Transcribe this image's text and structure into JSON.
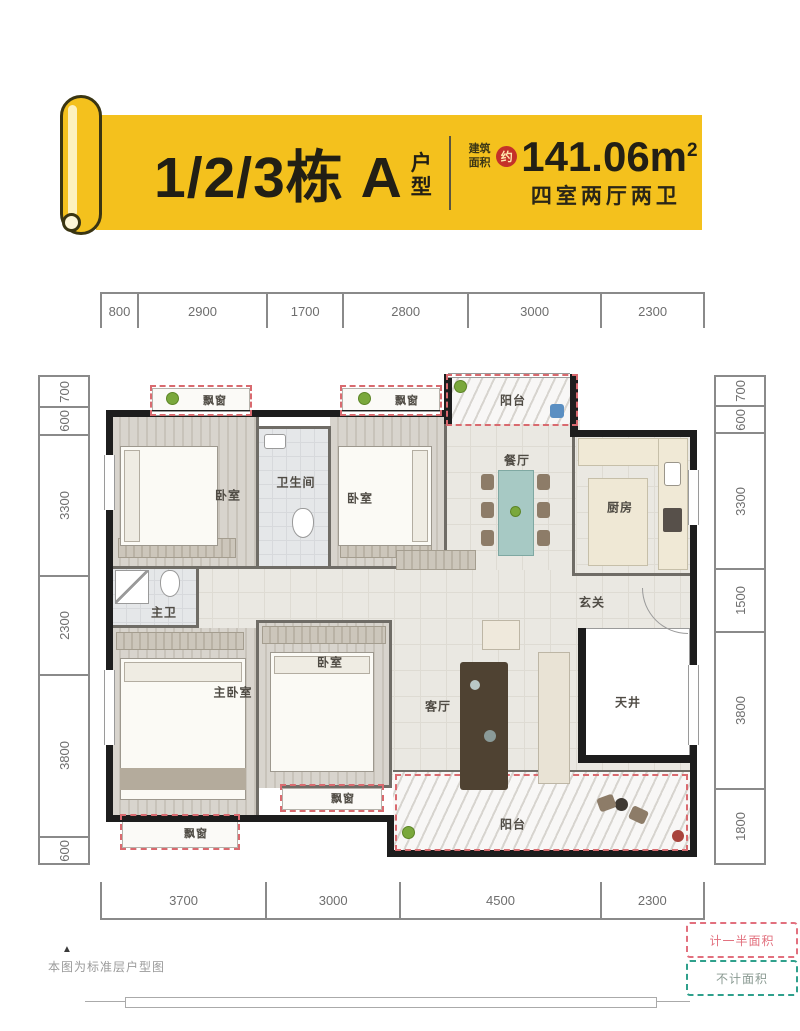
{
  "header": {
    "title": "1/2/3栋 A",
    "title_suffix": "户型",
    "area_label": "建筑面积",
    "approx": "约",
    "area_value": "141.06m",
    "area_sup": "2",
    "layout": "四室两厅两卫",
    "banner_color": "#F4C11D"
  },
  "dimensions": {
    "top": [
      "800",
      "2900",
      "1700",
      "2800",
      "3000",
      "2300"
    ],
    "bottom": [
      "3700",
      "3000",
      "4500",
      "2300"
    ],
    "left": [
      "700",
      "600",
      "3300",
      "2300",
      "3800",
      "600"
    ],
    "right": [
      "700",
      "600",
      "3300",
      "1500",
      "3800",
      "1800"
    ]
  },
  "rooms": {
    "bedroom_top_left": "卧室",
    "bathroom": "卫生间",
    "bedroom_top_mid": "卧室",
    "balcony_top": "阳台",
    "dining": "餐厅",
    "kitchen": "厨房",
    "foyer": "玄关",
    "master_bath": "主卫",
    "master_bedroom": "主卧室",
    "bedroom_mid": "卧室",
    "living": "客厅",
    "lightwell": "天井",
    "balcony_bottom": "阳台",
    "bay1": "飘窗",
    "bay2": "飘窗",
    "bay3": "飘窗",
    "bay4": "飘窗"
  },
  "legend": {
    "half_area": "计一半面积",
    "no_area": "不计面积"
  },
  "footnote": {
    "marker": "▲",
    "text": "本图为标准层户型图"
  },
  "colors": {
    "accent_red_dash": "#D96A6F",
    "accent_green_dash": "#2FA08C",
    "badge_red": "#C43129"
  }
}
